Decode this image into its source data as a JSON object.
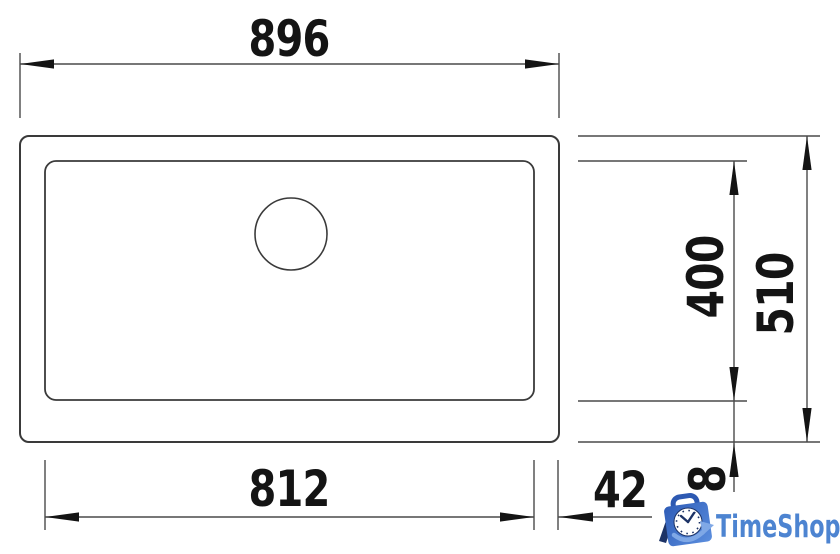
{
  "drawing": {
    "title": "sink-technical-top-view",
    "dimensions": {
      "top_width": "896",
      "bottom_width": "812",
      "side_offset": "42",
      "inner_depth": "400",
      "outer_depth": "510",
      "front_offset": "68"
    }
  },
  "watermark": {
    "name": "TimeShop"
  },
  "colors": {
    "line": "#4a4a4a",
    "outline": "#3a3a3a",
    "ink": "#141414",
    "logo_text": "#4d84d1",
    "logo_bag_dark": "#2e5cb7",
    "logo_bag_light": "#5b8ede",
    "logo_navy": "#1d3366",
    "logo_swoosh": "#7fa8e6",
    "clock_face": "#ffffff"
  }
}
